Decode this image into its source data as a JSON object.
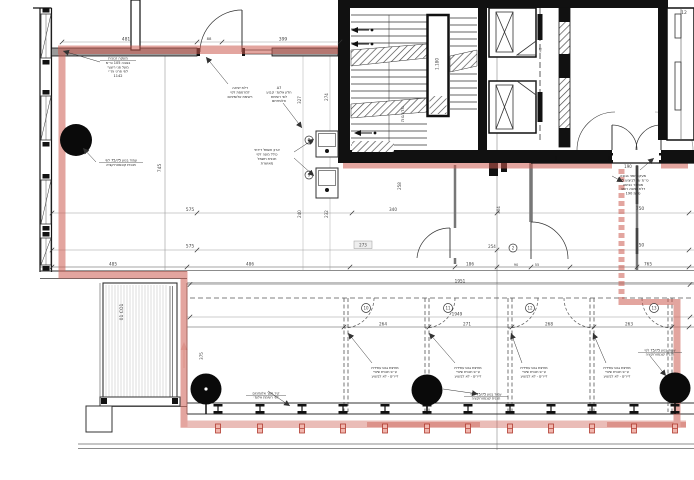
{
  "title": "floor-plan-drawing",
  "colors": {
    "wall": "#111111",
    "gray_wall": "#9a9a9a",
    "red_route": "#cd5c50",
    "red_dark": "#c0392b",
    "dim_text": "#444444"
  },
  "dims": {
    "top_left": "481",
    "top_door": "88",
    "top_right": "399",
    "room_height": "745",
    "ext_a": "327",
    "ext_b": "274",
    "ext_c": "240",
    "ext_d": "232",
    "corridor": "258",
    "corridor_b": "304",
    "deck": "375",
    "chain1_left": "575",
    "chain1_mid": "340",
    "chain1_right": "750",
    "chain2_left": "575",
    "chain2_right": "750",
    "chain3_a": "485",
    "chain3_b": "486",
    "chain3_d": "186",
    "chain3_e": "90",
    "chain3_f": "55",
    "chain3_g": "765",
    "room_tag": "273",
    "room2": "254",
    "lobby_door": "190",
    "band_total": "1951",
    "band_total_b": "1949",
    "band_a": "264",
    "band_b": "271",
    "band_c": "268",
    "band_d": "263"
  },
  "labels": {
    "deck_vertical": "01 CO1",
    "stair_vertical": "מדרגות",
    "stair_level": "1.180",
    "section_mark": "H2",
    "corner_mark": "12"
  },
  "bubbles": {
    "room_door": "2",
    "panel_a": "8",
    "panel_b": "9",
    "rooms": [
      "10",
      "11",
      "12",
      "13"
    ]
  },
  "notes": {
    "railing": [
      "מעקה זכוכית",
      "בגובה 105 ס״מ",
      "מעל פני ריצוף",
      "לפי פרט ות״י",
      "1142"
    ],
    "exit_door": [
      "דלת יציאה",
      "למרפסת לפי",
      "רשימת אלומיניום"
    ],
    "glazing": [
      "A7",
      "חלון אלומ׳ קבוע",
      "לפי רשימת",
      "אלומיניום"
    ],
    "panels": [
      "ארון חשמל דירתי",
      "כולל מונה לפי",
      "תכנית חשמל",
      "מאושרת"
    ],
    "column": [
      "עמוד בטון 75/75 לפי",
      "תכנית קונסטרוקציה"
    ],
    "lobby": [
      "מעקה זמני בגובה",
      "105 ס״מ עד לביצוע",
      "מסתור כביסה",
      "דלת כניסה רוחב",
      "190 ס״מ"
    ],
    "partition": [
      "מחיצת גבס עתידית",
      "ע״פ תכנית שינויי",
      "דיירים - לא לביצוע"
    ],
    "facade": [
      "קיר מסך אלומיניום",
      "לפי רשימת אלומ׳"
    ],
    "column_b": [
      "עמוד בטון 75/75 לפי",
      "תכנית קונסטרוקציה"
    ],
    "column_r": [
      "עמוד בטון 75/75 לפי",
      "תכנית קונסטרוקציה"
    ]
  }
}
